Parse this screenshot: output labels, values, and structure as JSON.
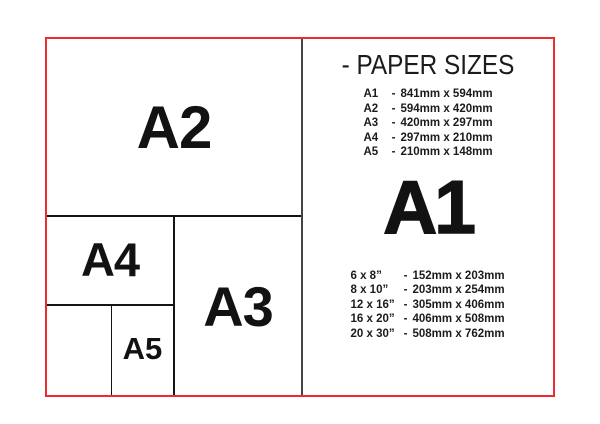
{
  "colors": {
    "background": "#ffffff",
    "frame_red": "#ee2b30",
    "divider_gray": "#454545",
    "line_black": "#141414",
    "text_black": "#161616"
  },
  "diagram": {
    "a2_label": "A2",
    "a3_label": "A3",
    "a4_label": "A4",
    "a5_label": "A5"
  },
  "panel": {
    "title": "- PAPER SIZES",
    "a_series": [
      {
        "name": "A1",
        "dash": "-",
        "size": "841mm x 594mm"
      },
      {
        "name": "A2",
        "dash": "-",
        "size": "594mm x 420mm"
      },
      {
        "name": "A3",
        "dash": "-",
        "size": "420mm x 297mm"
      },
      {
        "name": "A4",
        "dash": "-",
        "size": "297mm x 210mm"
      },
      {
        "name": "A5",
        "dash": "-",
        "size": "210mm x 148mm"
      }
    ],
    "featured_label": "A1",
    "inch_series": [
      {
        "name": "6 x 8”",
        "dash": "-",
        "size": "152mm x 203mm"
      },
      {
        "name": "8 x 10”",
        "dash": "-",
        "size": "203mm x 254mm"
      },
      {
        "name": "12 x 16”",
        "dash": "-",
        "size": "305mm x 406mm"
      },
      {
        "name": "16 x 20”",
        "dash": "-",
        "size": "406mm x 508mm"
      },
      {
        "name": "20 x 30”",
        "dash": "-",
        "size": "508mm x 762mm"
      }
    ]
  }
}
